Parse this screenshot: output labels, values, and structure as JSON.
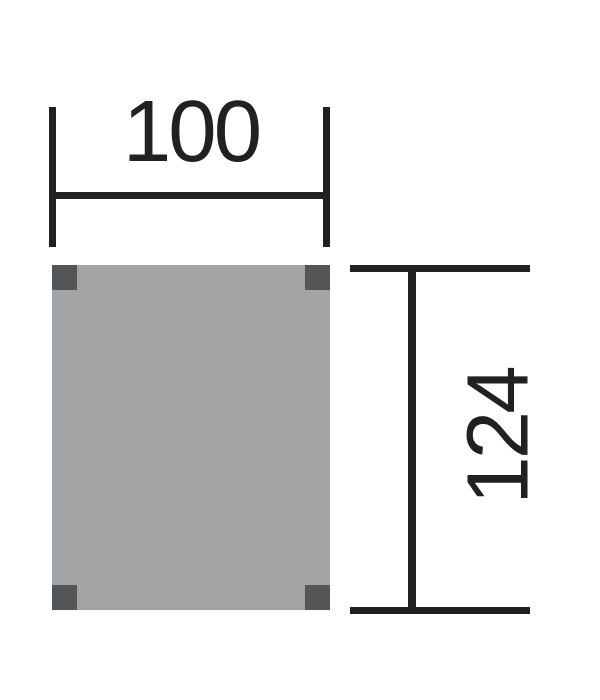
{
  "diagram": {
    "kind": "floor-plan dimension drawing",
    "width_dimension": {
      "value": "100"
    },
    "height_dimension": {
      "value": "124"
    }
  },
  "colors": {
    "line": "#212123",
    "panel_fill": "#a1a3a5",
    "post_fill": "#545557",
    "background": "#ffffff"
  }
}
